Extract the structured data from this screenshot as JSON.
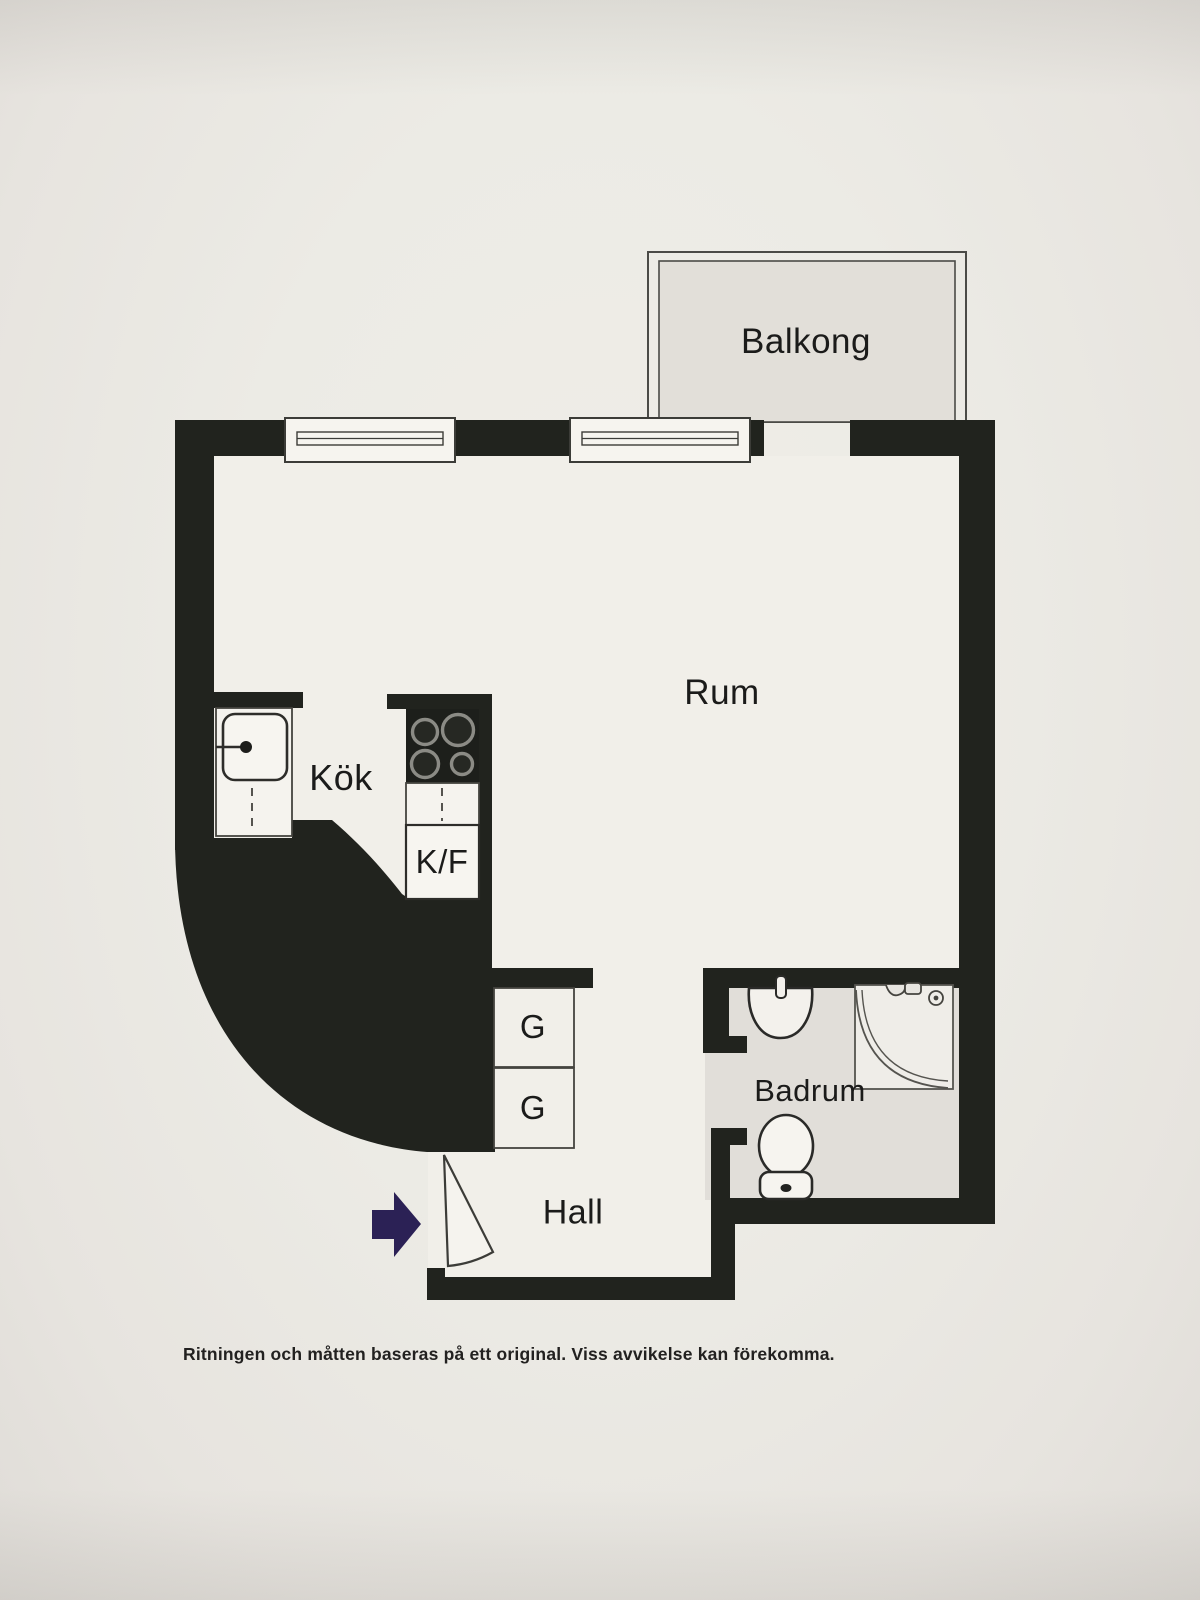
{
  "document": {
    "type": "apartment-floor-plan",
    "language": "sv"
  },
  "rooms": {
    "balcony": {
      "label": "Balkong"
    },
    "main_room": {
      "label": "Rum"
    },
    "kitchen": {
      "label": "Kök"
    },
    "fridge_freezer": {
      "label": "K/F"
    },
    "wardrobe_top": {
      "label": "G"
    },
    "wardrobe_bottom": {
      "label": "G"
    },
    "hall": {
      "label": "Hall"
    },
    "bathroom": {
      "label": "Badrum"
    }
  },
  "footer": {
    "disclaimer": "Ritningen och måtten baseras på ett original. Viss avvikelse kan förekomma."
  },
  "colors": {
    "wall": "#21231e",
    "paper": "#ecebe5",
    "interior_floor": "#f1efe9",
    "balcony_floor": "#e2dfd9",
    "bathroom_floor": "#e1ded9",
    "entrance_arrow": "#2b2155",
    "thin_line": "#45443f"
  }
}
